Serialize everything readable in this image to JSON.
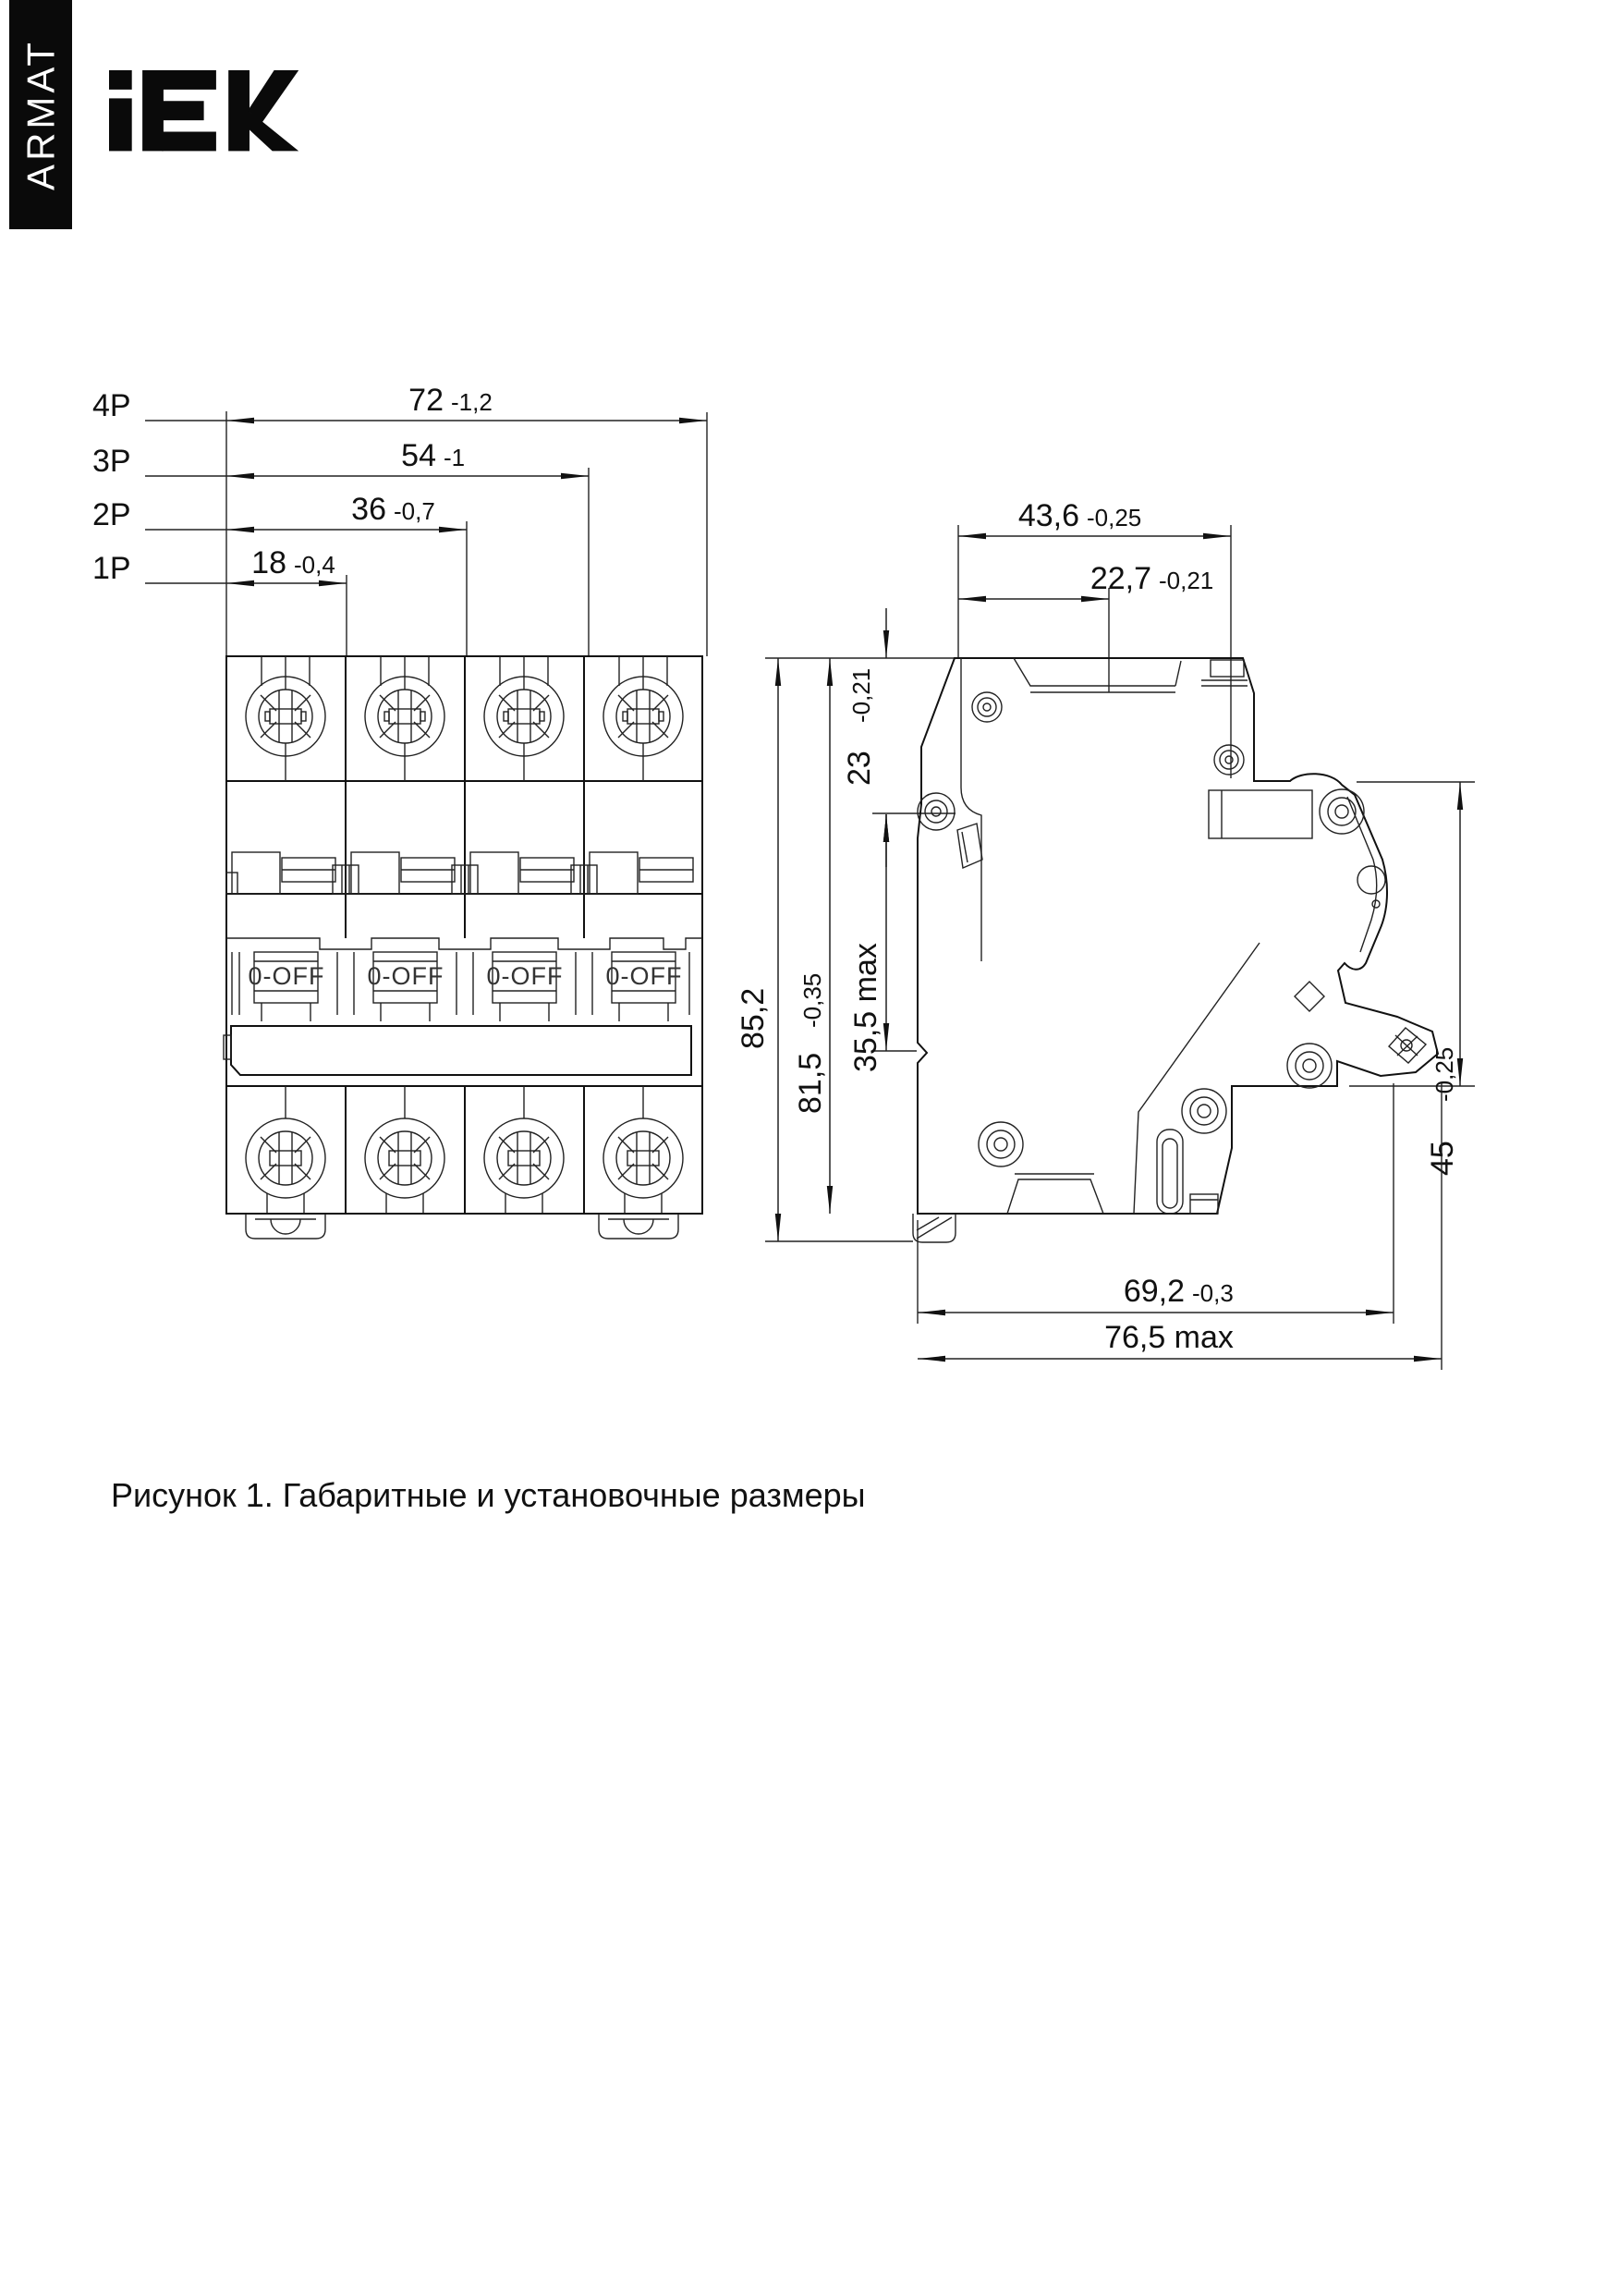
{
  "brand": {
    "logo_text": "IEK",
    "series_label": "ARMAT"
  },
  "figure": {
    "caption": "Рисунок 1. Габаритные и установочные размеры"
  },
  "front_view": {
    "toggle_label": "0-OFF",
    "pole_rows": [
      {
        "pole": "4P",
        "value": "72",
        "tol": "-1,2"
      },
      {
        "pole": "3P",
        "value": "54",
        "tol": "-1"
      },
      {
        "pole": "2P",
        "value": "36",
        "tol": "-0,7"
      },
      {
        "pole": "1P",
        "value": "18",
        "tol": "-0,4"
      }
    ]
  },
  "side_view": {
    "top_width": {
      "value": "43,6",
      "tol": "-0,25"
    },
    "handle_offset": {
      "value": "22,7",
      "tol": "-0,21"
    },
    "handle_height": {
      "value": "23",
      "tol": "-0,21"
    },
    "protrusion": {
      "value": "35,5 max"
    },
    "total_height": {
      "value": "85,2"
    },
    "body_height": {
      "value": "81,5",
      "tol": "-0,35"
    },
    "din_depth": {
      "value": "45",
      "tol": "-0,25"
    },
    "base_depth": {
      "value": "69,2",
      "tol": "-0,3"
    },
    "max_depth": {
      "value": "76,5 max"
    }
  }
}
